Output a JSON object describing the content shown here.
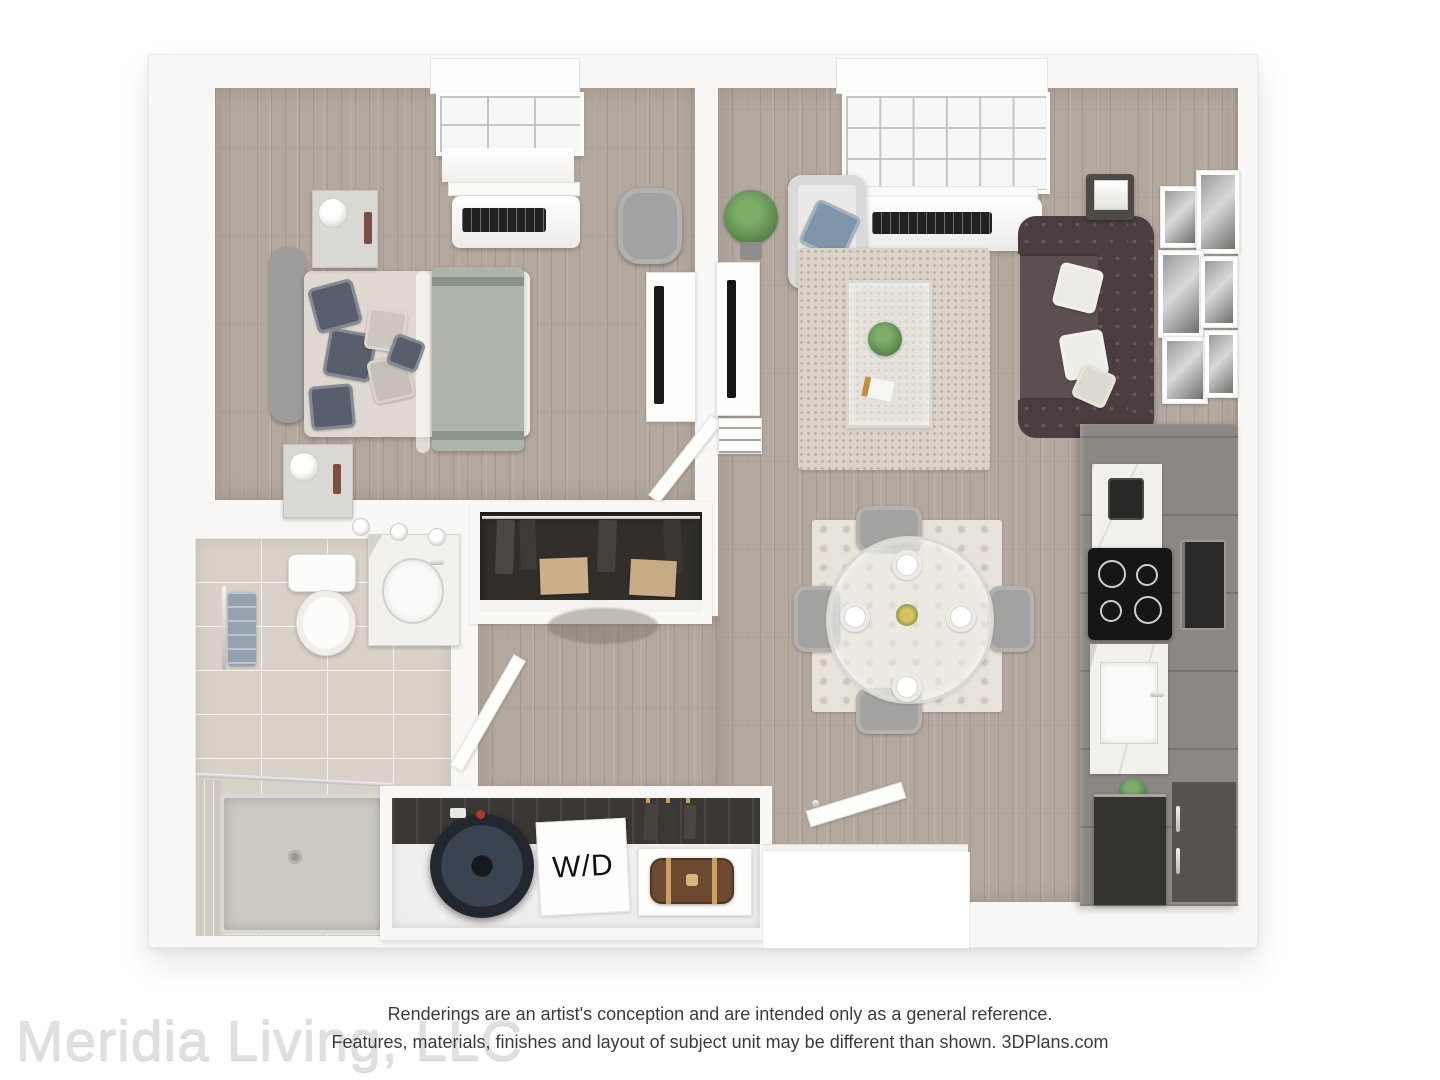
{
  "footer": {
    "disclaimer_line1": "Renderings are an artist's conception and are intended only as a general reference.",
    "disclaimer_line2": "Features, materials, finishes and layout of subject unit may be different than shown. 3DPlans.com",
    "watermark": "Meridia Living, LLC"
  },
  "labels": {
    "washer_dryer": "W/D"
  },
  "colors": {
    "background": "#ffffff",
    "wall": "#f8f7f5",
    "wood_floor": "#b3a89e",
    "tile_floor": "#d7d1c8",
    "closet_interior": "#322f2b",
    "sofa": "#4b3e41",
    "pillow_accent": "#7e95a8",
    "pillow_dark": "#585e6b",
    "armchair": "#e9e9e7",
    "rug_living": "#d8d2c7",
    "rug_dining": "#e8e3da",
    "bed_sheet": "#ded8d0",
    "bed_blanket": "#adb5ab",
    "headboard": "#9c9c9a",
    "cabinet": "#8b8784",
    "counter_marble": "#f2f0ec",
    "cooktop": "#161616",
    "appliance_dark": "#35332f",
    "fridge": "#57534f",
    "water_heater": "#242830",
    "bag_brown": "#6d4a2f",
    "plant_green": "#5f8f50",
    "towel_blue": "#93a2ae",
    "chair_gray": "#a3a2a0",
    "text_dark": "#3b3b3b",
    "watermark_gray": "#e0e0e0"
  }
}
